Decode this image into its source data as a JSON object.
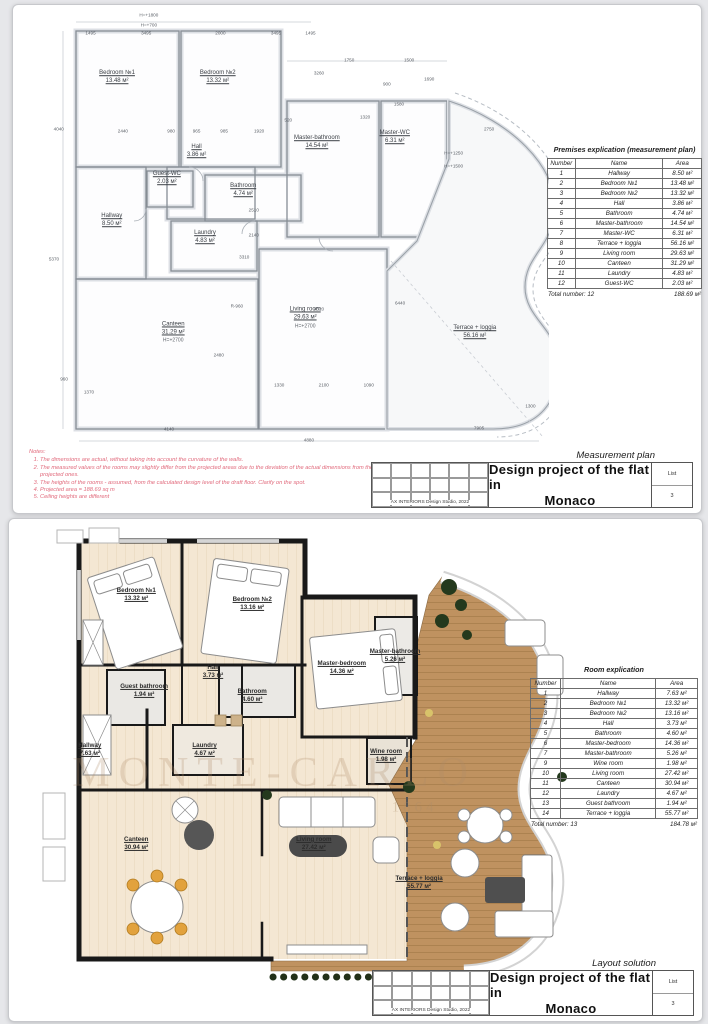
{
  "sheet1": {
    "plan_label": "Measurement plan",
    "rooms": [
      {
        "name": "Bedroom №1",
        "area": "13.48 м²",
        "x": 18.5,
        "y": 15.5
      },
      {
        "name": "Bedroom №2",
        "area": "13.32 м²",
        "x": 37.5,
        "y": 15.5
      },
      {
        "name": "Hall",
        "area": "3.86 м²",
        "x": 33.5,
        "y": 32.0
      },
      {
        "name": "Master-bathroom",
        "area": "14.54 м²",
        "x": 56.2,
        "y": 30.0
      },
      {
        "name": "Master-WC",
        "area": "6.31 м²",
        "x": 70.9,
        "y": 28.9
      },
      {
        "name": "Guest-WC",
        "area": "2.03 м²",
        "x": 27.9,
        "y": 38.1
      },
      {
        "name": "Bathroom",
        "area": "4.74 м²",
        "x": 42.3,
        "y": 40.8
      },
      {
        "name": "Hallway",
        "area": "8.50 м²",
        "x": 17.5,
        "y": 47.5
      },
      {
        "name": "Laundry",
        "area": "4.83 м²",
        "x": 35.1,
        "y": 51.3
      },
      {
        "name": "Canteen",
        "area": "31.29 м²",
        "sub": "H=+2700",
        "x": 29.1,
        "y": 72.6
      },
      {
        "name": "Living room",
        "area": "29.63 м²",
        "sub": "H=+2700",
        "x": 54.0,
        "y": 69.3
      },
      {
        "name": "Terrace + loggia",
        "area": "56.16 м²",
        "x": 86.0,
        "y": 72.6
      }
    ],
    "dims": [
      {
        "t": "1495",
        "x": 13.5,
        "y": 5.4
      },
      {
        "t": "3495",
        "x": 24.0,
        "y": 5.4
      },
      {
        "t": "2000",
        "x": 38.0,
        "y": 5.4
      },
      {
        "t": "3495",
        "x": 48.5,
        "y": 5.4
      },
      {
        "t": "1495",
        "x": 55.0,
        "y": 5.4
      },
      {
        "t": "H=+1800",
        "x": 24.5,
        "y": 1.4
      },
      {
        "t": "H=+700",
        "x": 24.5,
        "y": 3.5
      },
      {
        "t": "2440",
        "x": 19.6,
        "y": 27.4
      },
      {
        "t": "980",
        "x": 28.7,
        "y": 27.4
      },
      {
        "t": "965",
        "x": 33.5,
        "y": 27.4
      },
      {
        "t": "985",
        "x": 38.7,
        "y": 27.4
      },
      {
        "t": "1920",
        "x": 45.3,
        "y": 27.4
      },
      {
        "t": "520",
        "x": 50.8,
        "y": 24.9
      },
      {
        "t": "3260",
        "x": 56.6,
        "y": 14.3
      },
      {
        "t": "1750",
        "x": 62.3,
        "y": 11.4
      },
      {
        "t": "1500",
        "x": 73.6,
        "y": 11.4
      },
      {
        "t": "900",
        "x": 69.4,
        "y": 16.8
      },
      {
        "t": "1320",
        "x": 65.3,
        "y": 24.2
      },
      {
        "t": "1690",
        "x": 77.4,
        "y": 15.7
      },
      {
        "t": "1580",
        "x": 71.7,
        "y": 21.3
      },
      {
        "t": "2750",
        "x": 88.7,
        "y": 26.9
      },
      {
        "t": "H=+1250",
        "x": 82.0,
        "y": 32.3
      },
      {
        "t": "H=+1500",
        "x": 82.0,
        "y": 35.2
      },
      {
        "t": "4040",
        "x": 7.5,
        "y": 26.9
      },
      {
        "t": "5370",
        "x": 6.6,
        "y": 56.0
      },
      {
        "t": "960",
        "x": 8.5,
        "y": 83.0
      },
      {
        "t": "1370",
        "x": 13.2,
        "y": 85.9
      },
      {
        "t": "2510",
        "x": 44.3,
        "y": 45.0
      },
      {
        "t": "2140",
        "x": 44.3,
        "y": 50.7
      },
      {
        "t": "3310",
        "x": 42.5,
        "y": 55.6
      },
      {
        "t": "R-960",
        "x": 41.1,
        "y": 66.6
      },
      {
        "t": "6440",
        "x": 71.9,
        "y": 65.9
      },
      {
        "t": "4520",
        "x": 56.6,
        "y": 67.3
      },
      {
        "t": "1330",
        "x": 49.1,
        "y": 84.3
      },
      {
        "t": "2100",
        "x": 57.5,
        "y": 84.3
      },
      {
        "t": "1090",
        "x": 66.0,
        "y": 84.3
      },
      {
        "t": "2480",
        "x": 37.7,
        "y": 77.6
      },
      {
        "t": "4140",
        "x": 28.3,
        "y": 94.2
      },
      {
        "t": "4880",
        "x": 54.7,
        "y": 96.6
      },
      {
        "t": "7905",
        "x": 86.8,
        "y": 93.9
      },
      {
        "t": "1300",
        "x": 96.5,
        "y": 89.0
      }
    ],
    "table": {
      "title": "Premises explication (measurement plan)",
      "headers": [
        "Number",
        "Name",
        "Area"
      ],
      "rows": [
        [
          "1",
          "Hallway",
          "8.50 м²"
        ],
        [
          "2",
          "Bedroom №1",
          "13.48 м²"
        ],
        [
          "3",
          "Bedroom №2",
          "13.32 м²"
        ],
        [
          "4",
          "Hall",
          "3.86 м²"
        ],
        [
          "5",
          "Bathroom",
          "4.74 м²"
        ],
        [
          "6",
          "Master-bathroom",
          "14.54 м²"
        ],
        [
          "7",
          "Master-WC",
          "6.31 м²"
        ],
        [
          "8",
          "Terrace + loggia",
          "56.16 м²"
        ],
        [
          "9",
          "Living room",
          "29.63 м²"
        ],
        [
          "10",
          "Canteen",
          "31.29 м²"
        ],
        [
          "11",
          "Laundry",
          "4.83 м²"
        ],
        [
          "12",
          "Guest-WC",
          "2.03 м²"
        ]
      ],
      "total_label": "Total number: 12",
      "total_area": "188.69 м²"
    },
    "notes": {
      "title": "Notes:",
      "items": [
        "The dimensions are actual, without taking into account the curvature of the walls.",
        "The measured values of the rooms may slightly differ from the projected areas due to the deviation of the actual dimensions from the projected ones.",
        "The heights of the rooms - assumed, from the calculated design level of the draft floor. Clarify on the spot.",
        "Projected area = 188.69 sq m",
        "Ceiling heights are different"
      ]
    },
    "title_block": {
      "studio": "AX INTERIORS Design Studio, 2022",
      "title_line1": "Design project of the flat in",
      "title_line2": "Monaco",
      "list_label": "List",
      "list_number": "3"
    }
  },
  "sheet2": {
    "plan_label": "Layout solution",
    "watermark": {
      "line1": "MONTE-CARLO",
      "line2": "1864"
    },
    "rooms": [
      {
        "name": "Bedroom №1",
        "area": "13.32 м²",
        "x": 21.3,
        "y": 15.2
      },
      {
        "name": "Bedroom №2",
        "area": "13.16 м²",
        "x": 42.0,
        "y": 17.2
      },
      {
        "name": "Hall",
        "area": "3.73 м²",
        "x": 35.0,
        "y": 32.0
      },
      {
        "name": "Guest bathroom",
        "area": "1.94 м²",
        "x": 22.7,
        "y": 36.1
      },
      {
        "name": "Bathroom",
        "area": "4.60 м²",
        "x": 42.0,
        "y": 37.2
      },
      {
        "name": "Master-bedroom",
        "area": "14.36 м²",
        "x": 58.0,
        "y": 31.0
      },
      {
        "name": "Master-bathroom",
        "area": "5.26 м²",
        "x": 67.5,
        "y": 28.5
      },
      {
        "name": "Hallway",
        "area": "7.63 м²",
        "x": 13.0,
        "y": 49.0
      },
      {
        "name": "Laundry",
        "area": "4.67 м²",
        "x": 33.5,
        "y": 49.0
      },
      {
        "name": "Wine room",
        "area": "1.98 м²",
        "x": 65.9,
        "y": 50.2
      },
      {
        "name": "Canteen",
        "area": "30.94 м²",
        "x": 21.3,
        "y": 69.3
      },
      {
        "name": "Living room",
        "area": "27.42 м²",
        "x": 53.0,
        "y": 69.3
      },
      {
        "name": "Terrace + loggia",
        "area": "55.77 м²",
        "x": 71.8,
        "y": 77.8
      }
    ],
    "table": {
      "title": "Room explication",
      "headers": [
        "Number",
        "Name",
        "Area"
      ],
      "rows": [
        [
          "1",
          "Hallway",
          "7.63 м²"
        ],
        [
          "2",
          "Bedroom №1",
          "13.32 м²"
        ],
        [
          "3",
          "Bedroom №2",
          "13.16 м²"
        ],
        [
          "4",
          "Hall",
          "3.73 м²"
        ],
        [
          "5",
          "Bathroom",
          "4.60 м²"
        ],
        [
          "6",
          "Master-bedroom",
          "14.36 м²"
        ],
        [
          "7",
          "Master-bathroom",
          "5.26 м²"
        ],
        [
          "9",
          "Wine room",
          "1.98 м²"
        ],
        [
          "10",
          "Living room",
          "27.42 м²"
        ],
        [
          "11",
          "Canteen",
          "30.94 м²"
        ],
        [
          "12",
          "Laundry",
          "4.67 м²"
        ],
        [
          "13",
          "Guest bathroom",
          "1.94 м²"
        ],
        [
          "14",
          "Terrace + loggia",
          "55.77 м²"
        ]
      ],
      "total_label": "Total number: 13",
      "total_area": "184.78 м²"
    },
    "title_block": {
      "studio": "AX INTERIORS Design Studio, 2022",
      "title_line1": "Design project of the flat in",
      "title_line2": "Monaco",
      "list_label": "List",
      "list_number": "3"
    }
  }
}
